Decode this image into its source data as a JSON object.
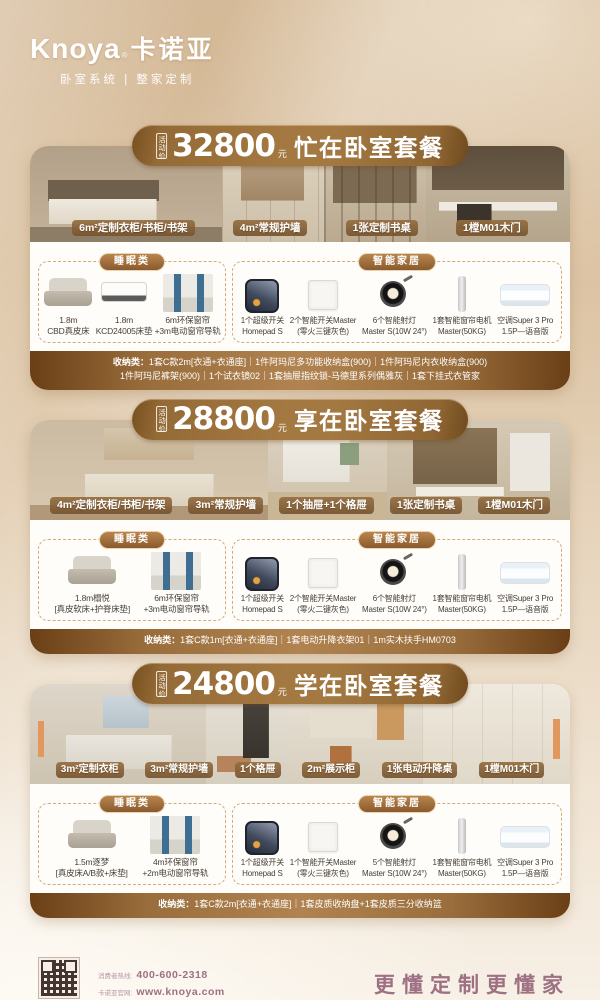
{
  "brand": {
    "logo_en": "Knoya",
    "reg": "®",
    "logo_cn": "卡诺亚",
    "tagline": "卧室系统 | 整家定制"
  },
  "colors": {
    "banner_brown": "#9a6e3c",
    "storage_bar_brown": "#8a5f33",
    "background_tan": "#dcc3a3",
    "footer_mauve": "#9d7083",
    "label_brown": "#8a6238"
  },
  "packages": [
    {
      "price_prefix": "活动价",
      "price": "32800",
      "price_unit": "元",
      "title": "忙在卧室套餐",
      "photo_labels": [
        "6m²定制衣柜/书柜/书架",
        "4m²常规护墙",
        "1张定制书桌",
        "1樘M01木门"
      ],
      "sleep": {
        "title": "睡眠类",
        "items": [
          {
            "line1": "1.8m",
            "line2": "CBD真皮床",
            "icon": "bed"
          },
          {
            "line1": "1.8m",
            "line2": "KCD24005床垫",
            "icon": "mattress"
          },
          {
            "line1": "6m环保窗帘",
            "line2": "+3m电动窗帘导轨",
            "icon": "curtain"
          }
        ]
      },
      "smart": {
        "title": "智能家居",
        "items": [
          {
            "line1": "1个超级开关",
            "line2": "Homepad S",
            "icon": "homepad"
          },
          {
            "line1": "2个智能开关Master",
            "line2": "(零火三键灰色)",
            "icon": "switch"
          },
          {
            "line1": "6个智能射灯",
            "line2": "Master S(10W 24°)",
            "icon": "spotlight"
          },
          {
            "line1": "1套智能窗帘电机",
            "line2": "Master(50KG)",
            "icon": "curtain-motor"
          },
          {
            "line1": "空调Super 3 Pro",
            "line2": "1.5P—语音版",
            "icon": "air-conditioner"
          }
        ]
      },
      "storage": {
        "label": "收纳类：",
        "line1": "1套C款2m[衣通+衣通座]｜1件阿玛尼多功能收纳盒(900)｜1件阿玛尼内衣收纳盒(900)",
        "line2": "1件阿玛尼裤架(900)｜1个试衣镜02｜1套抽屉指纹锁-马德里系列偶雅灰｜1套下挂式衣管家"
      }
    },
    {
      "price_prefix": "活动价",
      "price": "28800",
      "price_unit": "元",
      "title": "享在卧室套餐",
      "photo_labels": [
        "4m²定制衣柜/书柜/书架",
        "3m²常规护墙",
        "1个抽屉+1个格屉",
        "1张定制书桌",
        "1樘M01木门"
      ],
      "sleep": {
        "title": "睡眠类",
        "items": [
          {
            "line1": "1.8m榻悦",
            "line2": "[真皮软床+护脊床垫]",
            "icon": "bed"
          },
          {
            "line1": "6m环保窗帘",
            "line2": "+3m电动窗帘导轨",
            "icon": "curtain"
          }
        ]
      },
      "smart": {
        "title": "智能家居",
        "items": [
          {
            "line1": "1个超级开关",
            "line2": "Homepad S",
            "icon": "homepad"
          },
          {
            "line1": "2个智能开关Master",
            "line2": "(零火二键灰色)",
            "icon": "switch"
          },
          {
            "line1": "6个智能射灯",
            "line2": "Master S(10W 24°)",
            "icon": "spotlight"
          },
          {
            "line1": "1套智能窗帘电机",
            "line2": "Master(50KG)",
            "icon": "curtain-motor"
          },
          {
            "line1": "空调Super 3 Pro",
            "line2": "1.5P—语音版",
            "icon": "air-conditioner"
          }
        ]
      },
      "storage": {
        "label": "收纳类：",
        "line1": "1套C款1m[衣通+衣通座]｜1套电动升降衣架01｜1m实木扶手HM0703"
      }
    },
    {
      "price_prefix": "活动价",
      "price": "24800",
      "price_unit": "元",
      "title": "学在卧室套餐",
      "photo_labels": [
        "3m²定制衣柜",
        "3m²常规护墙",
        "1个格屉",
        "2m²展示柜",
        "1张电动升降桌",
        "1樘M01木门"
      ],
      "sleep": {
        "title": "睡眠类",
        "items": [
          {
            "line1": "1.5m逐梦",
            "line2": "[真皮床A/B款+床垫]",
            "icon": "bed"
          },
          {
            "line1": "4m环保窗帘",
            "line2": "+2m电动窗帘导轨",
            "icon": "curtain"
          }
        ]
      },
      "smart": {
        "title": "智能家居",
        "items": [
          {
            "line1": "1个超级开关",
            "line2": "Homepad S",
            "icon": "homepad"
          },
          {
            "line1": "1个智能开关Master",
            "line2": "(零火三键灰色)",
            "icon": "switch"
          },
          {
            "line1": "5个智能射灯",
            "line2": "Master S(10W 24°)",
            "icon": "spotlight"
          },
          {
            "line1": "1套智能窗帘电机",
            "line2": "Master(50KG)",
            "icon": "curtain-motor"
          },
          {
            "line1": "空调Super 3 Pro",
            "line2": "1.5P—语音版",
            "icon": "air-conditioner"
          }
        ]
      },
      "storage": {
        "label": "收纳类：",
        "line1": "1套C款2m[衣通+衣通座]｜1套皮质收纳盘+1套皮质三分收纳篮"
      }
    }
  ],
  "footer": {
    "qr_caption": "卡诺亚官方公众号 了解更多",
    "hotline_label": "消费者热线:",
    "hotline": "400-600-2318",
    "site_label": "卡诺亚官网:",
    "site": "www.knoya.com",
    "slogan": "更懂定制更懂家"
  }
}
